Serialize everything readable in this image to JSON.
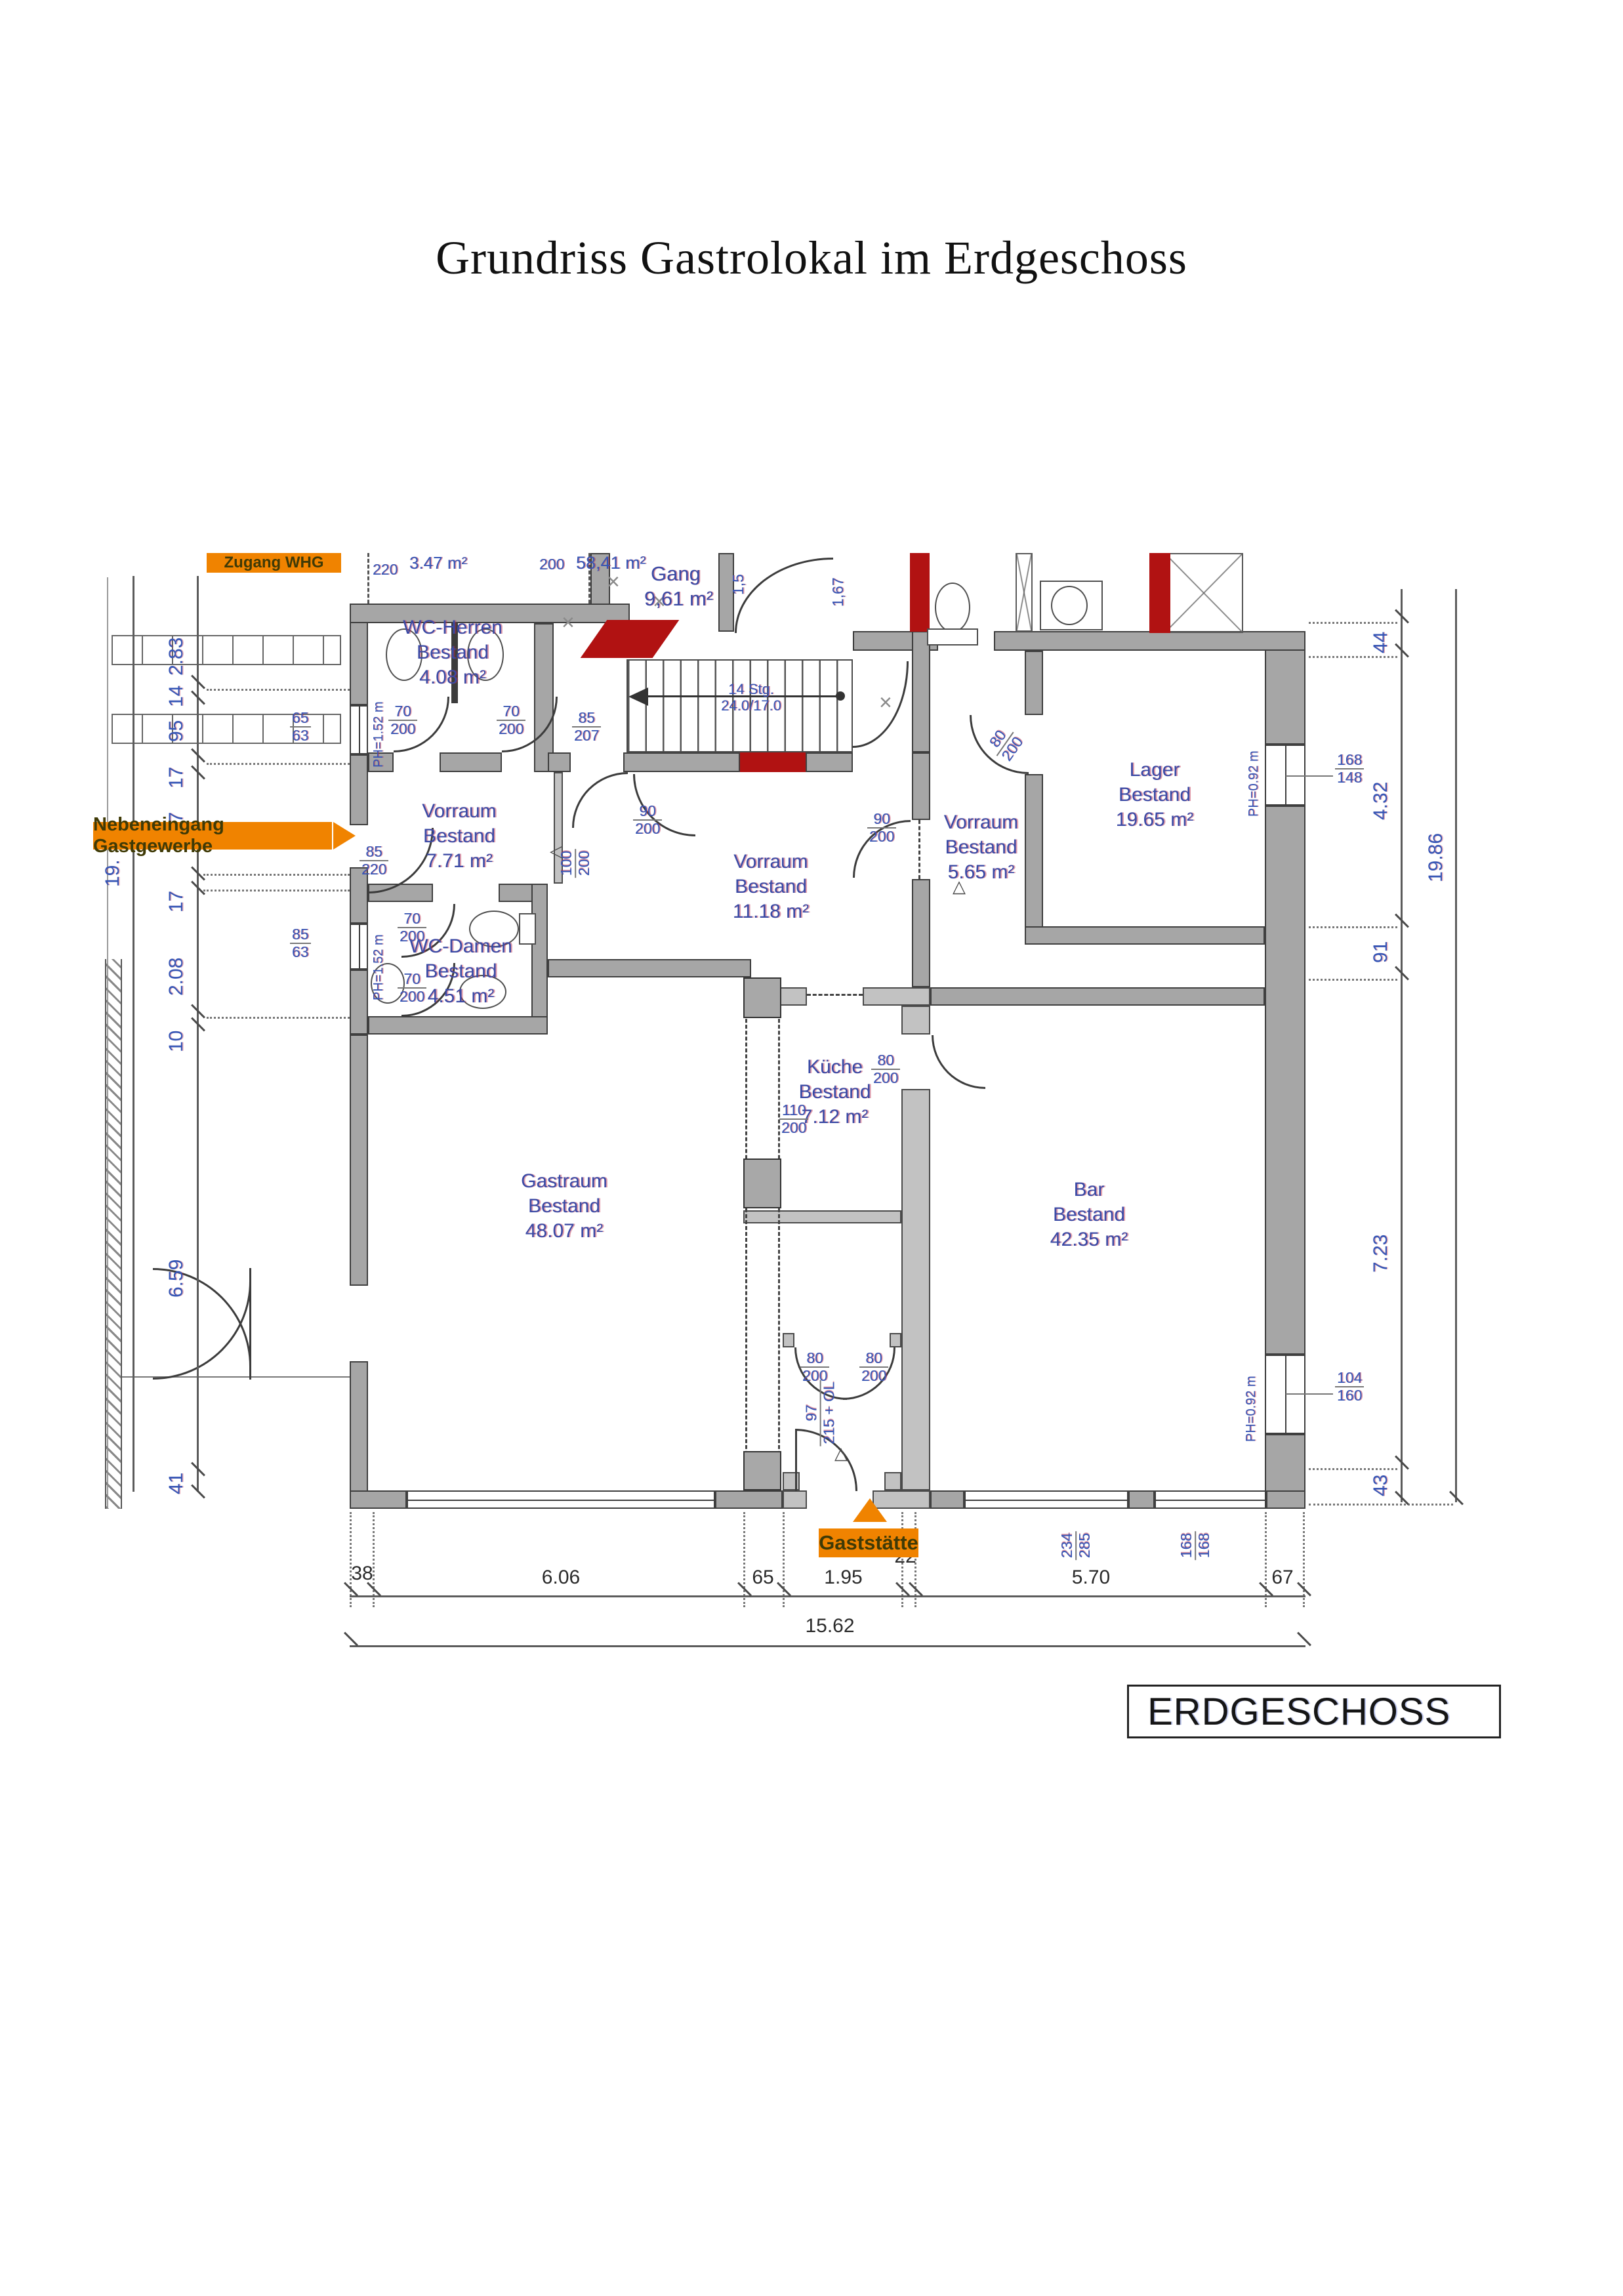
{
  "title": "Grundriss Gastrolokal im Erdgeschoss",
  "floor_tag": "ERDGESCHOSS",
  "labels": {
    "zugang": "Zugang WHG",
    "nebeneingang": "Nebeneingang Gastgewerbe",
    "gaststaette": "Gaststätte"
  },
  "top": {
    "d220": "220",
    "a347": "3.47 m²",
    "d200": "200",
    "a5841": "58,41 m²",
    "gang": "Gang",
    "gang_area": "9,61 m²",
    "v15": "1,5",
    "v167": "1,67"
  },
  "stairs": {
    "l1": "14 Stg.",
    "l2": "24.0/17.0"
  },
  "rooms": {
    "wc_herren": {
      "n": "WC-Herren",
      "b": "Bestand",
      "a": "4.08 m²"
    },
    "vorraum1": {
      "n": "Vorraum",
      "b": "Bestand",
      "a": "7.71 m²"
    },
    "vorraum2": {
      "n": "Vorraum",
      "b": "Bestand",
      "a": "11.18 m²"
    },
    "vorraum3": {
      "n": "Vorraum",
      "b": "Bestand",
      "a": "5.65 m²"
    },
    "lager": {
      "n": "Lager",
      "b": "Bestand",
      "a": "19.65 m²"
    },
    "wc_damen": {
      "n": "WC-Damen",
      "b": "Bestand",
      "a": "4.51 m²"
    },
    "kueche": {
      "n": "Küche",
      "b": "Bestand",
      "a": "7.12 m²"
    },
    "gastraum": {
      "n": "Gastraum",
      "b": "Bestand",
      "a": "48.07 m²"
    },
    "bar": {
      "n": "Bar",
      "b": "Bestand",
      "a": "42.35 m²"
    }
  },
  "dims": {
    "d70_200": {
      "n": "70",
      "d": "200"
    },
    "d85_220": {
      "n": "85",
      "d": "220"
    },
    "d90_200": {
      "n": "90",
      "d": "200"
    },
    "d100_200": {
      "n": "100",
      "d": "200"
    },
    "d80_200": {
      "n": "80",
      "d": "200"
    },
    "d110_200": {
      "n": "110",
      "d": "200"
    },
    "d85_207": {
      "n": "85",
      "d": "207"
    },
    "d97_215": {
      "n": "97",
      "d": "215 + OL"
    },
    "w65_63": {
      "n": "65",
      "d": "63"
    },
    "w85_63": {
      "n": "85",
      "d": "63"
    },
    "w168_148": {
      "n": "168",
      "d": "148"
    },
    "w104_160": {
      "n": "104",
      "d": "160"
    },
    "w168_168": {
      "n": "168",
      "d": "168"
    },
    "w234_285": {
      "n": "234",
      "d": "285"
    }
  },
  "ph": {
    "p152": "PH=1.52 m",
    "p092": "PH=0.92 m"
  },
  "chains": {
    "bottom": {
      "s38": "38",
      "s606": "6.06",
      "s65": "65",
      "s195": "1.95",
      "s22": "22",
      "s570": "5.70",
      "s67": "67",
      "total": "15.62"
    },
    "left": {
      "s283": "2.83",
      "s14": "14",
      "s95": "95",
      "s17a": "17",
      "s37": "37",
      "s17b": "17",
      "s208": "2.08",
      "s10": "10",
      "s659": "6.59",
      "s41": "41",
      "total": "19."
    },
    "right": {
      "s44": "44",
      "s432": "4.32",
      "s91": "91",
      "s723": "7.23",
      "s43": "43",
      "total": "19.86"
    }
  }
}
